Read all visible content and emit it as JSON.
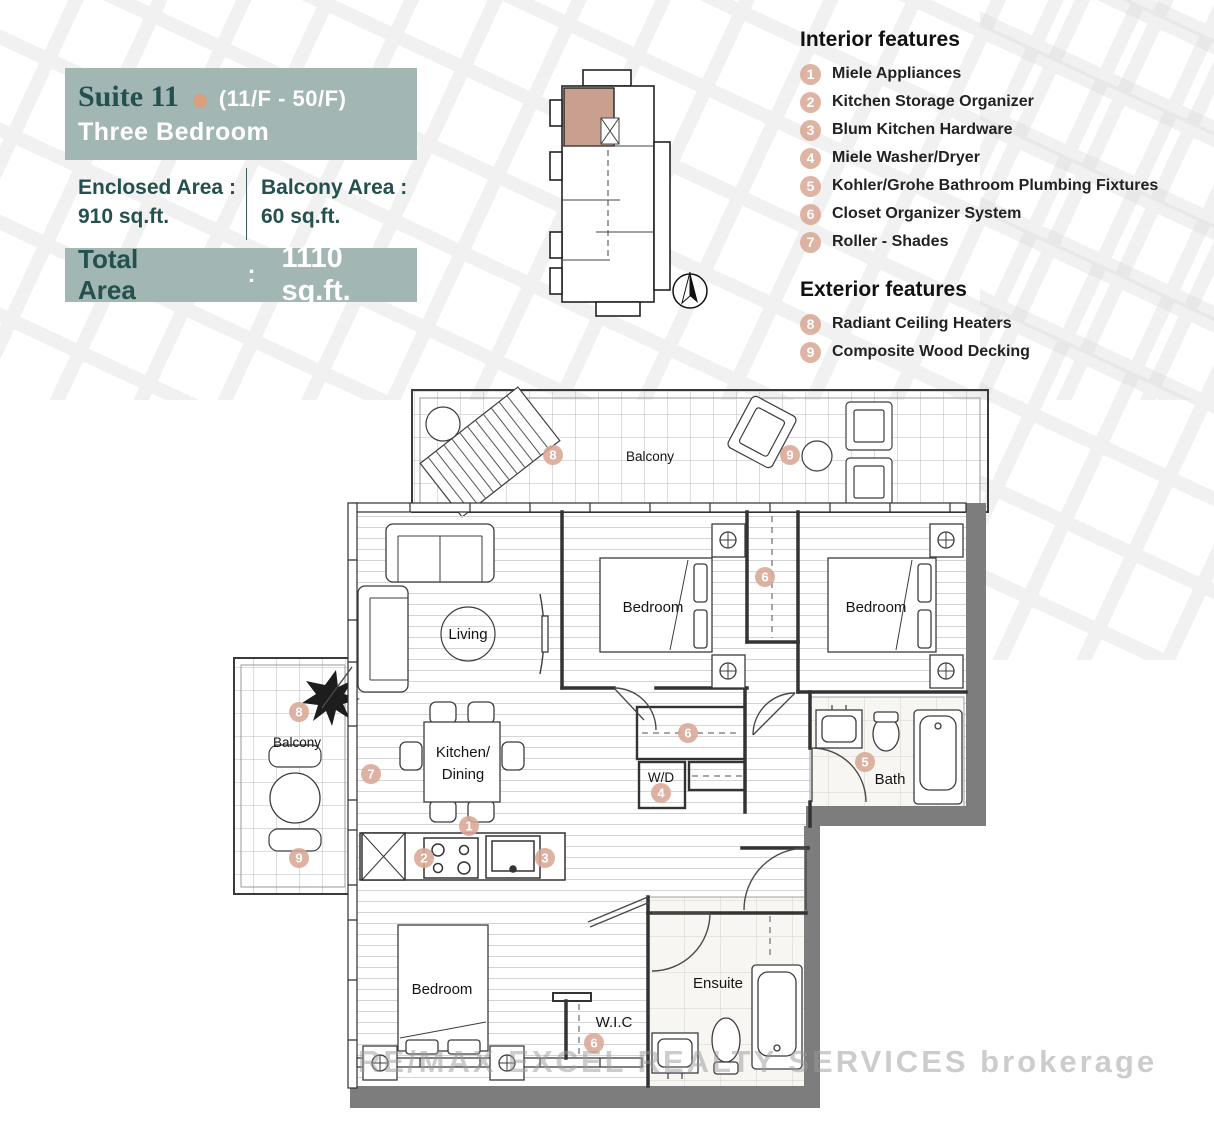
{
  "header": {
    "suite": "Suite 11",
    "floors": "(11/F - 50/F)",
    "type": "Three Bedroom",
    "enclosed_label": "Enclosed Area :",
    "enclosed_value": "910 sq.ft.",
    "balcony_label": "Balcony Area :",
    "balcony_value": "60 sq.ft.",
    "total_label": "Total Area",
    "total_colon": ":",
    "total_value": "1110 sq.ft."
  },
  "features": {
    "interior_title": "Interior features",
    "interior": [
      {
        "num": "1",
        "label": "Miele Appliances"
      },
      {
        "num": "2",
        "label": "Kitchen Storage Organizer"
      },
      {
        "num": "3",
        "label": "Blum Kitchen Hardware"
      },
      {
        "num": "4",
        "label": "Miele Washer/Dryer"
      },
      {
        "num": "5",
        "label": "Kohler/Grohe Bathroom Plumbing Fixtures"
      },
      {
        "num": "6",
        "label": "Closet Organizer System"
      },
      {
        "num": "7",
        "label": "Roller - Shades"
      }
    ],
    "exterior_title": "Exterior features",
    "exterior": [
      {
        "num": "8",
        "label": "Radiant Ceiling Heaters"
      },
      {
        "num": "9",
        "label": "Composite Wood Decking"
      }
    ]
  },
  "plan": {
    "rooms": {
      "balcony_top": "Balcony",
      "balcony_left": "Balcony",
      "living": "Living",
      "bedroom1": "Bedroom",
      "bedroom2": "Bedroom",
      "bedroom3": "Bedroom",
      "kitchen_line1": "Kitchen/",
      "kitchen_line2": "Dining",
      "wd": "W/D",
      "bath": "Bath",
      "ensuite": "Ensuite",
      "wic": "W.I.C"
    },
    "markers": [
      {
        "n": "8",
        "x": 553,
        "y": 455
      },
      {
        "n": "9",
        "x": 790,
        "y": 455
      },
      {
        "n": "6",
        "x": 765,
        "y": 577
      },
      {
        "n": "6",
        "x": 688,
        "y": 733
      },
      {
        "n": "4",
        "x": 661,
        "y": 793
      },
      {
        "n": "5",
        "x": 865,
        "y": 762
      },
      {
        "n": "7",
        "x": 371,
        "y": 774
      },
      {
        "n": "1",
        "x": 469,
        "y": 826
      },
      {
        "n": "2",
        "x": 424,
        "y": 858
      },
      {
        "n": "3",
        "x": 545,
        "y": 858
      },
      {
        "n": "6",
        "x": 594,
        "y": 1043
      },
      {
        "n": "8",
        "x": 299,
        "y": 712
      },
      {
        "n": "9",
        "x": 299,
        "y": 858
      }
    ]
  },
  "watermark_text": "RE/MAX EXCEL REALTY SERVICES brokerage",
  "colors": {
    "teal": "#A2B6B3",
    "dark_teal": "#24504E",
    "accent": "#D9A795",
    "highlight_unit": "#C99F8F",
    "wall_gray": "#7d7d7d"
  }
}
